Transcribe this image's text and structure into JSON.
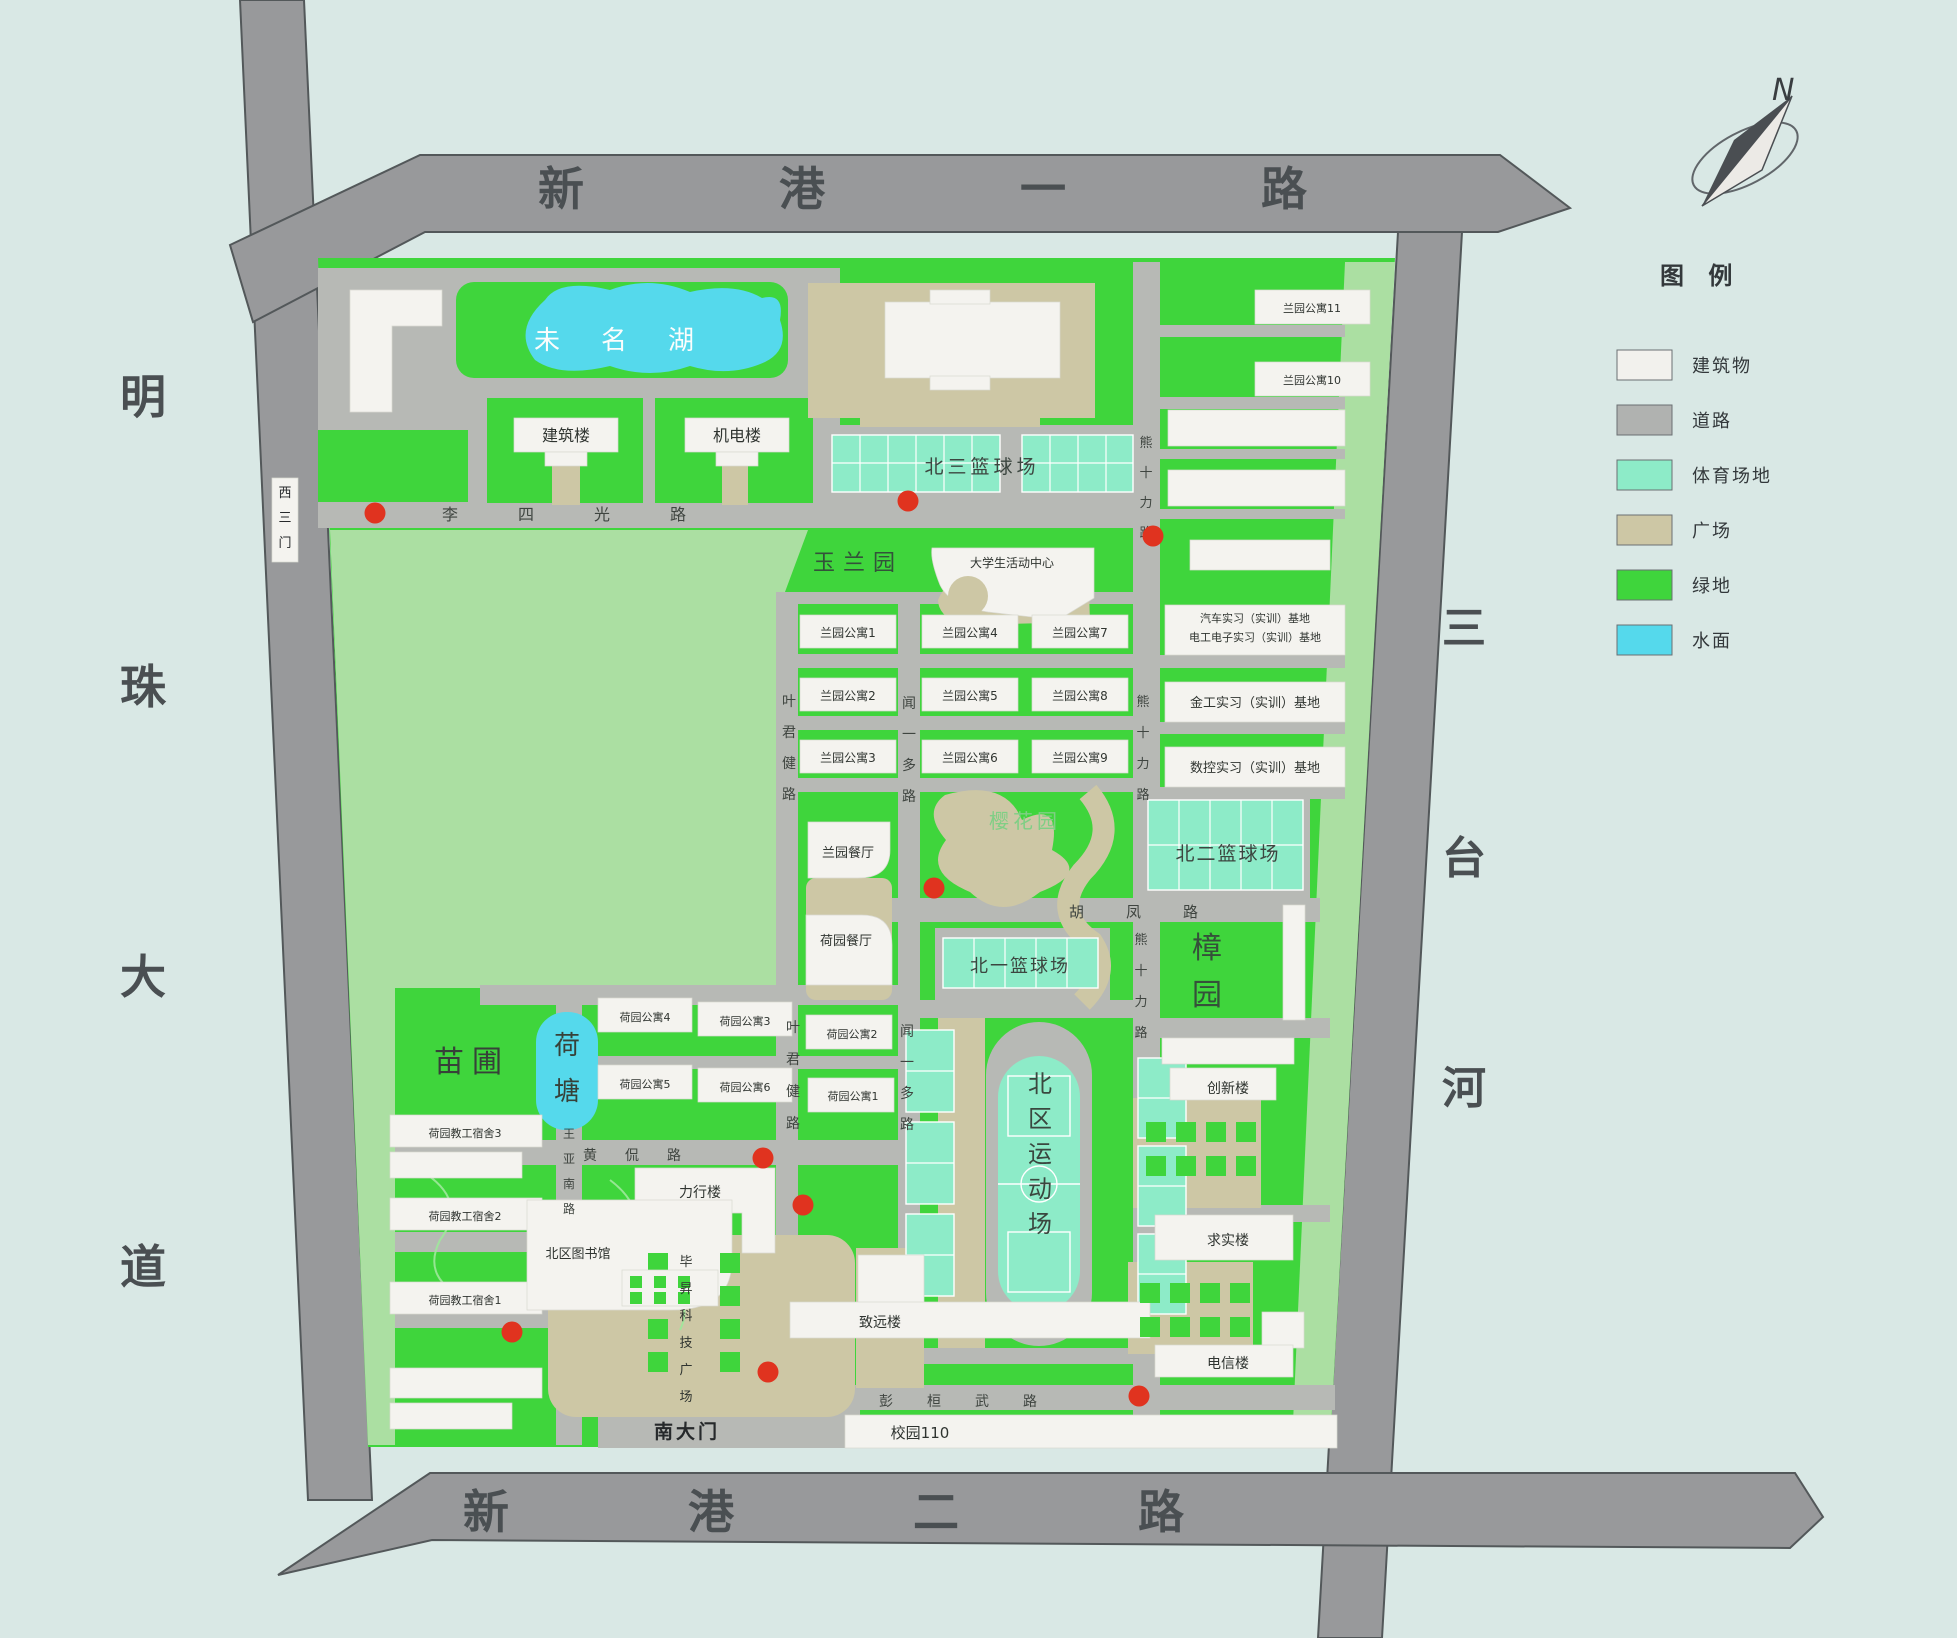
{
  "map": {
    "colors": {
      "background": "#d9e8e5",
      "outer_road": "#98999b",
      "inner_road": "#b7b9b5",
      "green": "#3fd53c",
      "light_green": "#abdfa2",
      "sports": "#8debc8",
      "plaza": "#cdc7a5",
      "water": "#55d9ec",
      "building": "#f4f3ef",
      "marker_red": "#e0331f"
    },
    "dot_radius": 10.5,
    "dots": [
      {
        "x": 375,
        "y": 513
      },
      {
        "x": 908,
        "y": 501
      },
      {
        "x": 1153,
        "y": 536
      },
      {
        "x": 934,
        "y": 888
      },
      {
        "x": 763,
        "y": 1158
      },
      {
        "x": 803,
        "y": 1205
      },
      {
        "x": 512,
        "y": 1332
      },
      {
        "x": 768,
        "y": 1372
      },
      {
        "x": 1139,
        "y": 1396
      }
    ],
    "labels": [
      {
        "name": "road-xingang-1",
        "text": "新港一路",
        "x": 538,
        "y": 205,
        "size": 46,
        "color": "#4a4f52",
        "anchor": "start",
        "spacing": 195,
        "weight": "600"
      },
      {
        "name": "road-xingang-2",
        "text": "新港二路",
        "x": 463,
        "y": 1528,
        "size": 46,
        "color": "#4a4f52",
        "anchor": "start",
        "spacing": 179,
        "weight": "600"
      },
      {
        "name": "road-mingzhu-avenue",
        "text": "明珠大道",
        "x": 143,
        "y": 413,
        "size": 46,
        "color": "#4a4f52",
        "vertical": true,
        "dy": 290,
        "weight": "600"
      },
      {
        "name": "river-santai",
        "text": "三台河",
        "x": 1464,
        "y": 643,
        "size": 44,
        "color": "#4a4f52",
        "vertical": true,
        "dy": 230,
        "weight": "600"
      },
      {
        "name": "road-lisiguang",
        "text": "李四光路",
        "x": 442,
        "y": 520,
        "size": 16,
        "color": "#3f4540",
        "anchor": "start",
        "spacing": 60
      },
      {
        "name": "road-yejunjian-north",
        "text": "叶君健路",
        "x": 789,
        "y": 706,
        "size": 14,
        "color": "#3f4540",
        "vertical": true,
        "dy": 31
      },
      {
        "name": "road-yejunjian-south",
        "text": "叶君健路",
        "x": 793,
        "y": 1032,
        "size": 14,
        "color": "#3f4540",
        "vertical": true,
        "dy": 32
      },
      {
        "name": "road-wenyiduo-north",
        "text": "闻一多路",
        "x": 909,
        "y": 708,
        "size": 14,
        "color": "#3f4540",
        "vertical": true,
        "dy": 31
      },
      {
        "name": "road-wenyiduo-south",
        "text": "闻一多路",
        "x": 907,
        "y": 1036,
        "size": 14,
        "color": "#3f4540",
        "vertical": true,
        "dy": 31
      },
      {
        "name": "road-xiongshili-1",
        "text": "熊十力路",
        "x": 1146,
        "y": 447,
        "size": 13,
        "color": "#3f4540",
        "vertical": true,
        "dy": 30
      },
      {
        "name": "road-xiongshili-2",
        "text": "熊十力路",
        "x": 1143,
        "y": 706,
        "size": 13,
        "color": "#3f4540",
        "vertical": true,
        "dy": 31
      },
      {
        "name": "road-xiongshili-3",
        "text": "熊十力路",
        "x": 1141,
        "y": 944,
        "size": 13,
        "color": "#3f4540",
        "vertical": true,
        "dy": 31
      },
      {
        "name": "road-hufeng",
        "text": "胡凤路",
        "x": 1069,
        "y": 917,
        "size": 15,
        "color": "#3f4540",
        "anchor": "start",
        "spacing": 42
      },
      {
        "name": "road-huangkan",
        "text": "黄侃路",
        "x": 583,
        "y": 1160,
        "size": 14,
        "color": "#3f4540",
        "anchor": "start",
        "spacing": 28
      },
      {
        "name": "road-wangyanan",
        "text": "王亚南路",
        "x": 569,
        "y": 1138,
        "size": 12,
        "color": "#3f4540",
        "vertical": true,
        "dy": 25
      },
      {
        "name": "road-penghuanwu",
        "text": "彭桓武路",
        "x": 879,
        "y": 1406,
        "size": 14,
        "color": "#3f4540",
        "anchor": "start",
        "spacing": 34
      },
      {
        "name": "gate-south",
        "text": "南大门",
        "x": 687,
        "y": 1438,
        "size": 19,
        "color": "#26292b",
        "spacing": 3,
        "weight": "bold"
      },
      {
        "name": "gate-west-3",
        "text": "西三门",
        "x": 285,
        "y": 497,
        "size": 13,
        "color": "#26292b",
        "vertical": true,
        "dy": 25
      },
      {
        "name": "lake-weiming",
        "text": "未名湖",
        "x": 534,
        "y": 349,
        "size": 26,
        "color": "#fbfdfc",
        "anchor": "start",
        "spacing": 41
      },
      {
        "name": "pond-hetang",
        "text": "荷塘",
        "x": 567,
        "y": 1054,
        "size": 26,
        "color": "#374139",
        "vertical": true,
        "dy": 46
      },
      {
        "name": "garden-yulan",
        "text": "玉兰园",
        "x": 858,
        "y": 570,
        "size": 22,
        "color": "#33523a",
        "spacing": 8
      },
      {
        "name": "garden-yinghua",
        "text": "樱花园",
        "x": 1025,
        "y": 828,
        "size": 20,
        "color": "#7fcf85",
        "spacing": 4
      },
      {
        "name": "garden-zhangyuan",
        "text": "樟园",
        "x": 1207,
        "y": 958,
        "size": 30,
        "color": "#35503a",
        "vertical": true,
        "dy": 47
      },
      {
        "name": "garden-miaopu",
        "text": "苗圃",
        "x": 472,
        "y": 1072,
        "size": 30,
        "color": "#374139",
        "spacing": 8
      },
      {
        "name": "court-north3",
        "text": "北三篮球场",
        "x": 982,
        "y": 473,
        "size": 19,
        "color": "#3c4640",
        "spacing": 4
      },
      {
        "name": "court-north2",
        "text": "北二篮球场",
        "x": 1228,
        "y": 860,
        "size": 19,
        "color": "#3c4640",
        "spacing": 2
      },
      {
        "name": "court-north1",
        "text": "北一篮球场",
        "x": 1020,
        "y": 972,
        "size": 18,
        "color": "#3c4640",
        "spacing": 2
      },
      {
        "name": "stadium-north",
        "text": "北区运动场",
        "x": 1040,
        "y": 1092,
        "size": 24,
        "color": "#3a473f",
        "vertical": true,
        "dy": 35
      },
      {
        "name": "bld-jianzhulou",
        "text": "建筑楼",
        "x": 566,
        "y": 441,
        "size": 16
      },
      {
        "name": "bld-jidianlou",
        "text": "机电楼",
        "x": 737,
        "y": 441,
        "size": 16
      },
      {
        "name": "bld-lanyuan-apt11",
        "text": "兰园公寓11",
        "x": 1312,
        "y": 312,
        "size": 11
      },
      {
        "name": "bld-lanyuan-apt10",
        "text": "兰园公寓10",
        "x": 1312,
        "y": 384,
        "size": 11
      },
      {
        "name": "bld-activity-center",
        "text": "大学生活动中心",
        "x": 1012,
        "y": 567,
        "size": 12
      },
      {
        "name": "bld-lanyuan-apt1",
        "text": "兰园公寓1",
        "x": 848,
        "y": 637,
        "size": 12
      },
      {
        "name": "bld-lanyuan-apt2",
        "text": "兰园公寓2",
        "x": 848,
        "y": 700,
        "size": 12
      },
      {
        "name": "bld-lanyuan-apt3",
        "text": "兰园公寓3",
        "x": 848,
        "y": 762,
        "size": 12
      },
      {
        "name": "bld-lanyuan-apt4",
        "text": "兰园公寓4",
        "x": 970,
        "y": 637,
        "size": 12
      },
      {
        "name": "bld-lanyuan-apt5",
        "text": "兰园公寓5",
        "x": 970,
        "y": 700,
        "size": 12
      },
      {
        "name": "bld-lanyuan-apt6",
        "text": "兰园公寓6",
        "x": 970,
        "y": 762,
        "size": 12
      },
      {
        "name": "bld-lanyuan-apt7",
        "text": "兰园公寓7",
        "x": 1080,
        "y": 637,
        "size": 12
      },
      {
        "name": "bld-lanyuan-apt8",
        "text": "兰园公寓8",
        "x": 1080,
        "y": 700,
        "size": 12
      },
      {
        "name": "bld-lanyuan-apt9",
        "text": "兰园公寓9",
        "x": 1080,
        "y": 762,
        "size": 12
      },
      {
        "name": "bld-auto-training-line1",
        "text": "汽车实习（实训）基地",
        "x": 1255,
        "y": 622,
        "size": 11
      },
      {
        "name": "bld-auto-training-line2",
        "text": "电工电子实习（实训）基地",
        "x": 1255,
        "y": 641,
        "size": 11
      },
      {
        "name": "bld-metalwork-training",
        "text": "金工实习（实训）基地",
        "x": 1255,
        "y": 707,
        "size": 13
      },
      {
        "name": "bld-cnc-training",
        "text": "数控实习（实训）基地",
        "x": 1255,
        "y": 772,
        "size": 13
      },
      {
        "name": "bld-lanyuan-canteen",
        "text": "兰园餐厅",
        "x": 848,
        "y": 857,
        "size": 13
      },
      {
        "name": "bld-heyuan-canteen",
        "text": "荷园餐厅",
        "x": 846,
        "y": 945,
        "size": 13
      },
      {
        "name": "bld-heyuan-apt4",
        "text": "荷园公寓4",
        "x": 645,
        "y": 1021,
        "size": 11
      },
      {
        "name": "bld-heyuan-apt3",
        "text": "荷园公寓3",
        "x": 745,
        "y": 1025,
        "size": 11
      },
      {
        "name": "bld-heyuan-apt2",
        "text": "荷园公寓2",
        "x": 852,
        "y": 1038,
        "size": 11
      },
      {
        "name": "bld-heyuan-apt5",
        "text": "荷园公寓5",
        "x": 645,
        "y": 1088,
        "size": 11
      },
      {
        "name": "bld-heyuan-apt6",
        "text": "荷园公寓6",
        "x": 745,
        "y": 1091,
        "size": 11
      },
      {
        "name": "bld-heyuan-apt1",
        "text": "荷园公寓1",
        "x": 853,
        "y": 1100,
        "size": 11
      },
      {
        "name": "bld-staff-dorm3",
        "text": "荷园教工宿舍3",
        "x": 465,
        "y": 1137,
        "size": 11
      },
      {
        "name": "bld-staff-dorm2",
        "text": "荷园教工宿舍2",
        "x": 465,
        "y": 1220,
        "size": 11
      },
      {
        "name": "bld-staff-dorm1",
        "text": "荷园教工宿舍1",
        "x": 465,
        "y": 1304,
        "size": 11
      },
      {
        "name": "bld-lixinglou",
        "text": "力行楼",
        "x": 700,
        "y": 1197,
        "size": 14
      },
      {
        "name": "bld-north-library",
        "text": "北区图书馆",
        "x": 578,
        "y": 1258,
        "size": 13
      },
      {
        "name": "plaza-bisheng",
        "text": "毕昇科技广场",
        "x": 686,
        "y": 1266,
        "size": 13,
        "vertical": true,
        "dy": 27
      },
      {
        "name": "bld-zhiyuanlou",
        "text": "致远楼",
        "x": 880,
        "y": 1327,
        "size": 14
      },
      {
        "name": "bld-chuangxinlou",
        "text": "创新楼",
        "x": 1228,
        "y": 1093,
        "size": 14
      },
      {
        "name": "bld-qiushilou",
        "text": "求实楼",
        "x": 1228,
        "y": 1245,
        "size": 14
      },
      {
        "name": "bld-dianxinlou",
        "text": "电信楼",
        "x": 1228,
        "y": 1368,
        "size": 14
      },
      {
        "name": "bld-campus110",
        "text": "校园110",
        "x": 920,
        "y": 1438,
        "size": 15
      }
    ]
  },
  "legend": {
    "title": "图  例",
    "items": [
      {
        "label": "建筑物",
        "color": "#f2f1ed"
      },
      {
        "label": "道路",
        "color": "#b0b2b0"
      },
      {
        "label": "体育场地",
        "color": "#8debc8"
      },
      {
        "label": "广场",
        "color": "#cdc7a5"
      },
      {
        "label": "绿地",
        "color": "#3fd53c"
      },
      {
        "label": "水面",
        "color": "#55d9ec"
      }
    ]
  },
  "compass": {
    "north_label": "N"
  }
}
